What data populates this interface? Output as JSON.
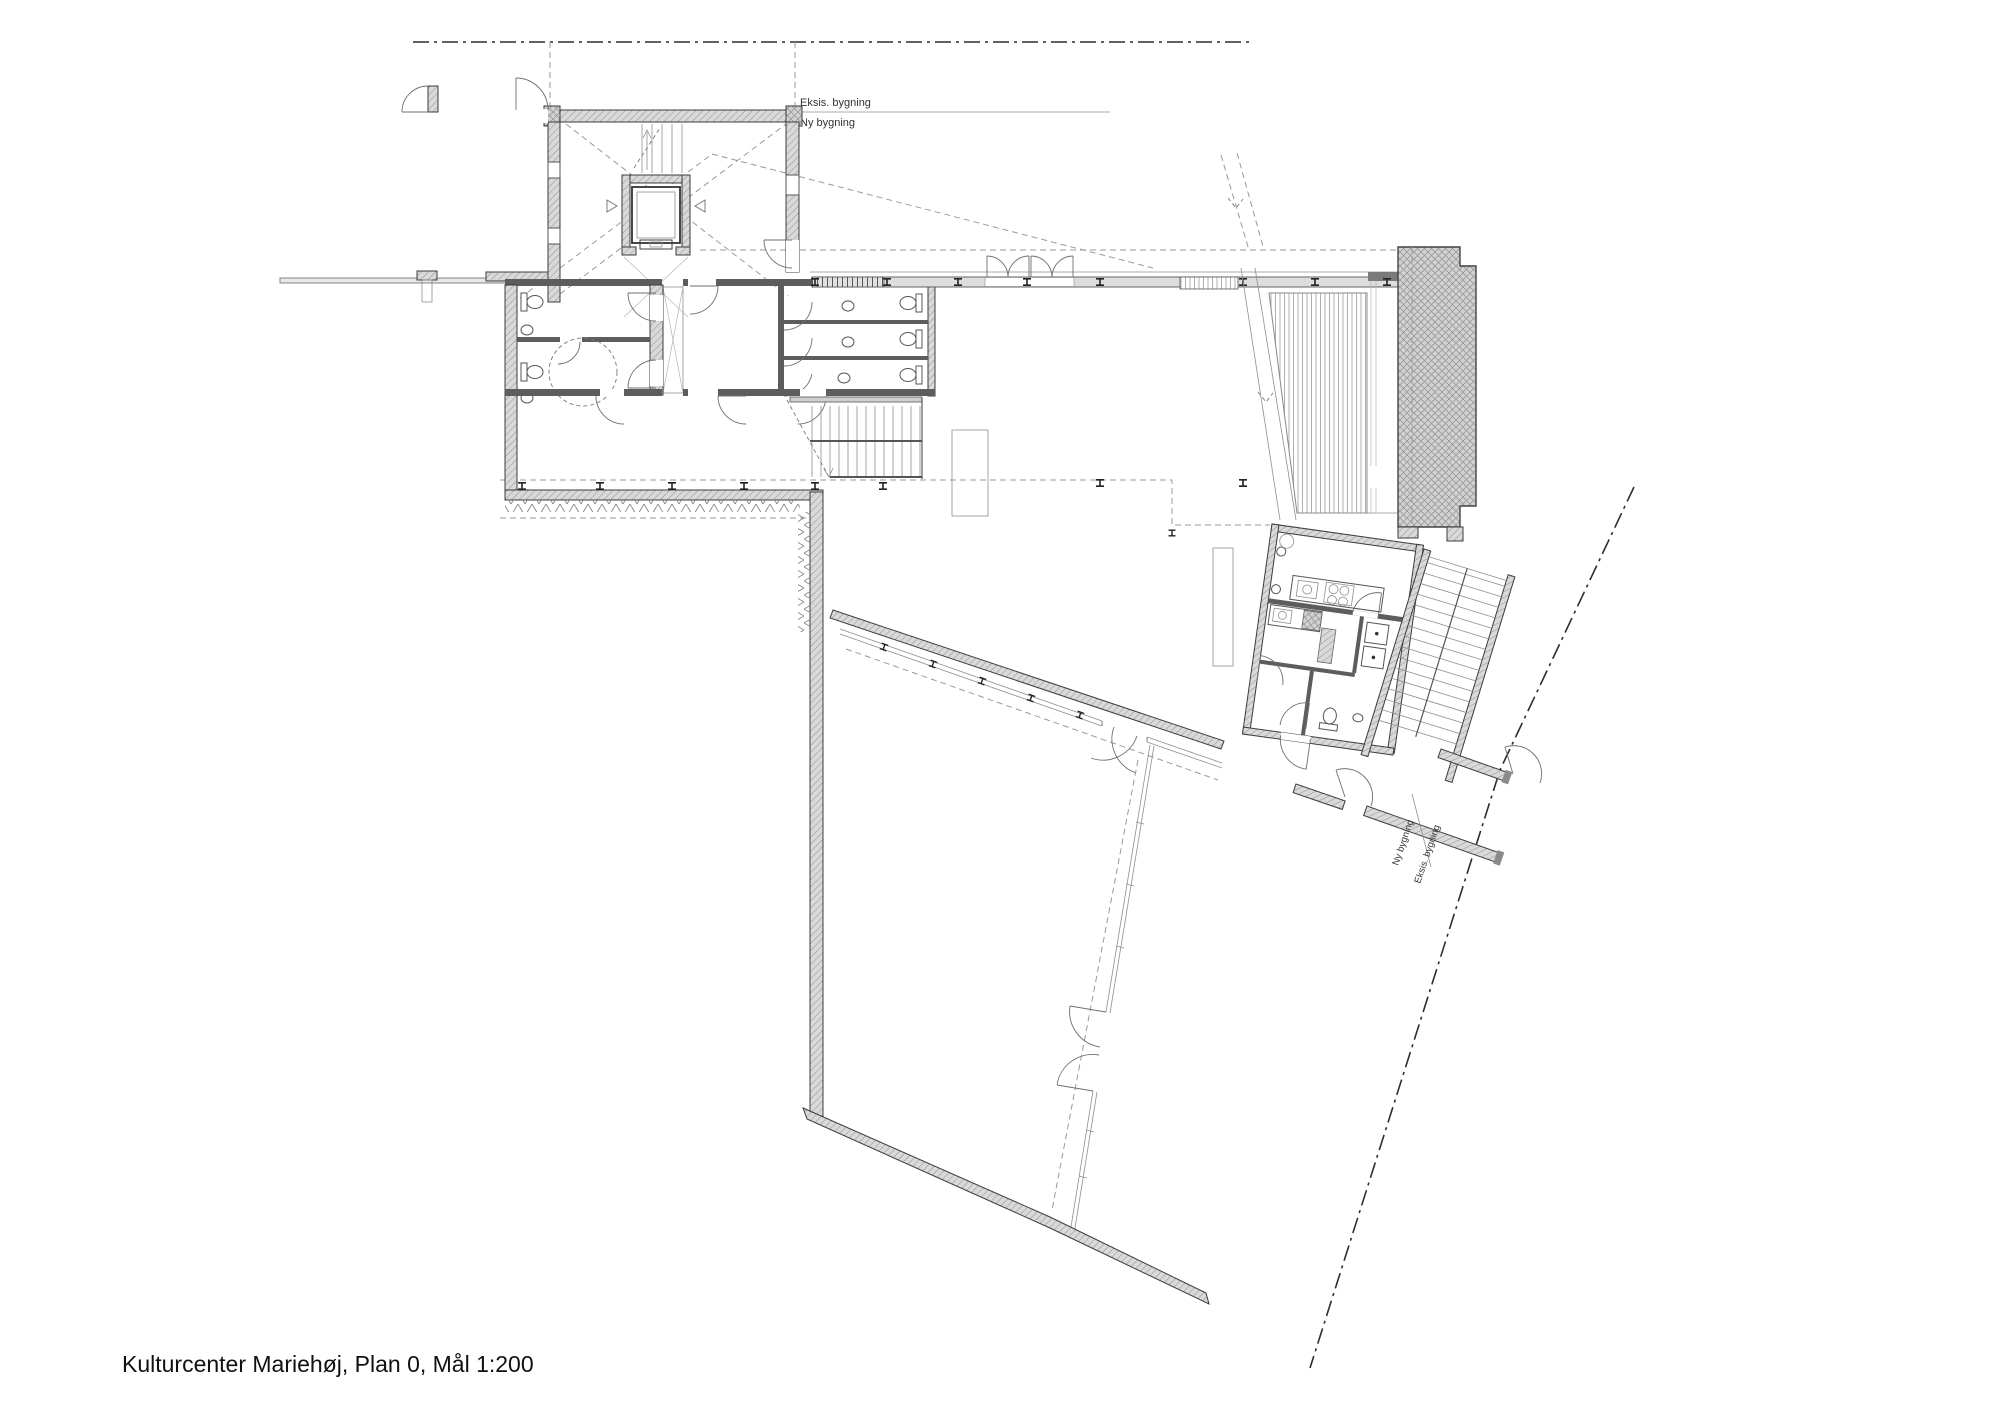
{
  "drawing": {
    "title": "Kulturcenter Mariehøj,  Plan 0, Mål 1:200"
  },
  "labels": {
    "boundary_top_existing": "Eksis. bygning",
    "boundary_top_new": "Ny bygning",
    "boundary_bottom_new": "Ny bygning",
    "boundary_bottom_existing": "Eksis. bygning"
  },
  "colors": {
    "background": "#ffffff",
    "linework": "#3c3c3c",
    "wall_fill": "#d9d9d9"
  }
}
